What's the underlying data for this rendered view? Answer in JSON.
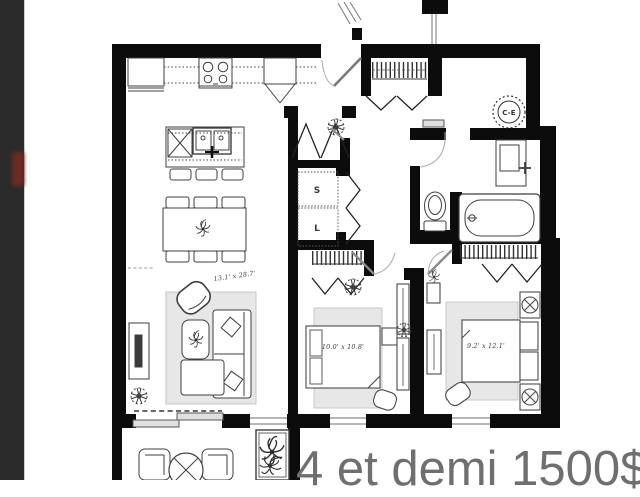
{
  "frame": {
    "left_panel_color": "#2b2b2b",
    "left_panel_indicator_color": "#6e2b22",
    "background": "#ffffff"
  },
  "floorplan": {
    "ink_color": "#0c0c0c",
    "rug_color": "#e7e7e7",
    "rooms": {
      "living_room": {
        "dimensions": "13.1' x 28.7'"
      },
      "bedroom_1": {
        "dimensions": "10.0' x 10.8'"
      },
      "bedroom_2": {
        "dimensions": "9.2' x 12.1'"
      }
    },
    "labels": {
      "water_heater": "C-E",
      "dryer": "S",
      "washer": "L"
    }
  },
  "listing": {
    "caption": "4 et demi 1500$",
    "caption_color": "#6f6f6f"
  }
}
